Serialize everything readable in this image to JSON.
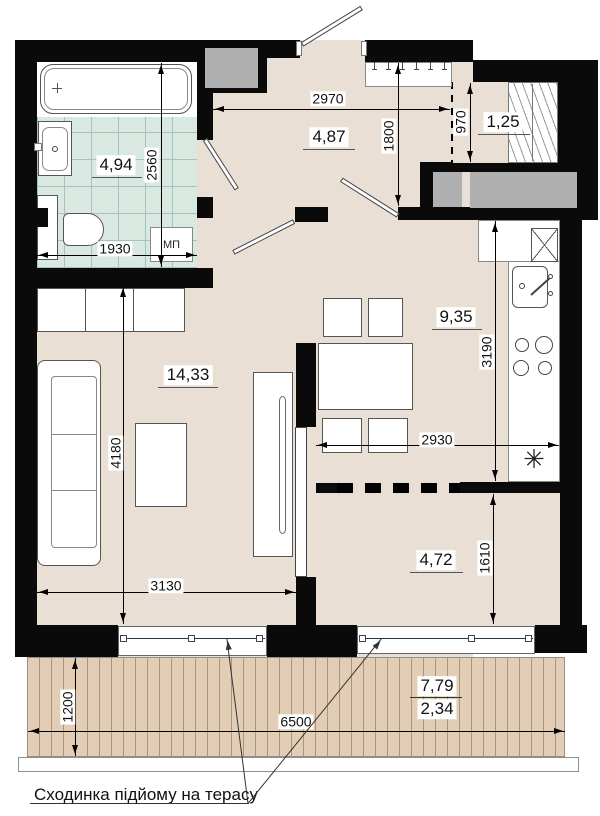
{
  "title": "apartment-floor-plan",
  "rooms": {
    "bathroom": "4,94",
    "hallway": "4,87",
    "closet": "1,25",
    "kitchen": "9,35",
    "living_room": "14,33",
    "nook": "4,72",
    "terrace_area": "7,79",
    "terrace_reduced": "2,34"
  },
  "dims": {
    "hall_width": "2970",
    "hall_depth": "1800",
    "closet_width": "970",
    "bathroom_depth": "2560",
    "bathroom_width": "1930",
    "living_depth": "4180",
    "living_width": "3130",
    "kitchen_depth": "3190",
    "kitchen_width": "2930",
    "nook_depth": "1610",
    "terrace_depth": "1200",
    "terrace_width": "6500"
  },
  "labels": {
    "washer": "МП",
    "kitchen_symbol": "✳"
  },
  "note": {
    "terrace_step": "Сходинка підйому на терасу"
  },
  "colors": {
    "wall": "#0a0a0a",
    "floor": "#eadfd5",
    "tile": "#d9e8e1",
    "deck": "#e3ceb5",
    "shaft": "#b0b0b0"
  }
}
